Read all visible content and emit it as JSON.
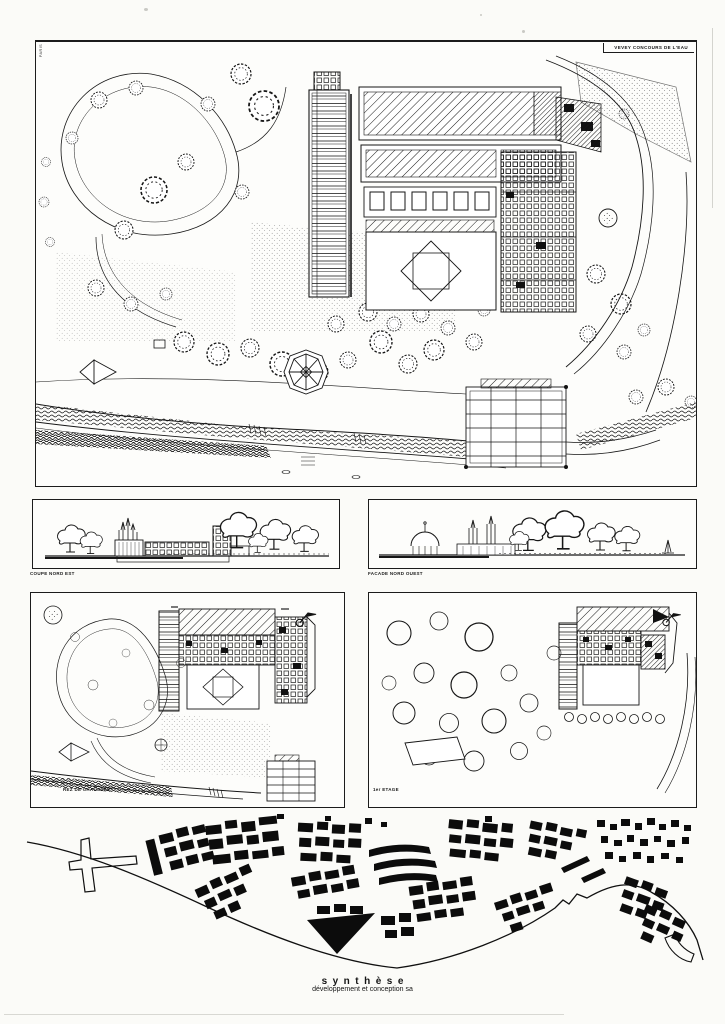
{
  "title_block": {
    "project_title": "VEVEY CONCOURS DE L'EAU",
    "stamp_vertical": "PARIS"
  },
  "captions": {
    "elevation_left": "COUPE NORD EST",
    "elevation_right": "FACADE NORD OUEST",
    "plan_left": "REZ DE CHAUSSEE",
    "plan_right": "1er ETAGE"
  },
  "footer": {
    "firm_name": "synthèse",
    "firm_subtitle": "développement et conception  sa"
  },
  "icons": {
    "north_arrow": "north-arrow",
    "sailboat": "sailboat",
    "tree": "tree-canopy",
    "kiosk": "octagonal-kiosk"
  },
  "colors": {
    "ink": "#161616",
    "paper": "#fbfbf8",
    "block_fill": "#0c0c0c"
  }
}
